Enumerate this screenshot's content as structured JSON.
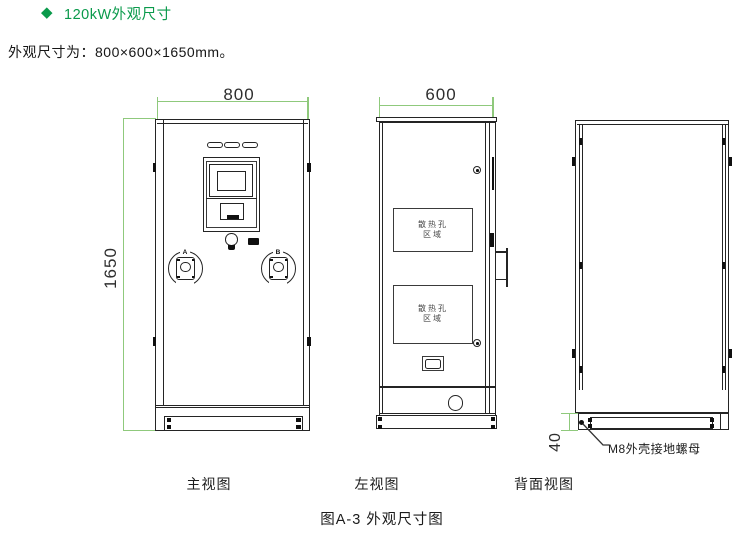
{
  "colors": {
    "title_green": "#0a9a4b",
    "dimension_green": "#8fc97c",
    "line_color": "#242424"
  },
  "header": {
    "bullet": "◆",
    "title": "120kW外观尺寸"
  },
  "intro": {
    "text": "外观尺寸为：800×600×1650mm。"
  },
  "front_view": {
    "caption": "主视图",
    "width_mm": "800",
    "height_mm": "1650",
    "gun_a_label": "A",
    "gun_b_label": "B"
  },
  "left_view": {
    "caption": "左视图",
    "depth_mm": "600",
    "vent_line1": "散热孔",
    "vent_line2": "区域"
  },
  "back_view": {
    "caption": "背面视图",
    "base_height_mm": "40",
    "ground_label": "M8外壳接地螺母"
  },
  "figure": {
    "caption": "图A-3 外观尺寸图"
  }
}
